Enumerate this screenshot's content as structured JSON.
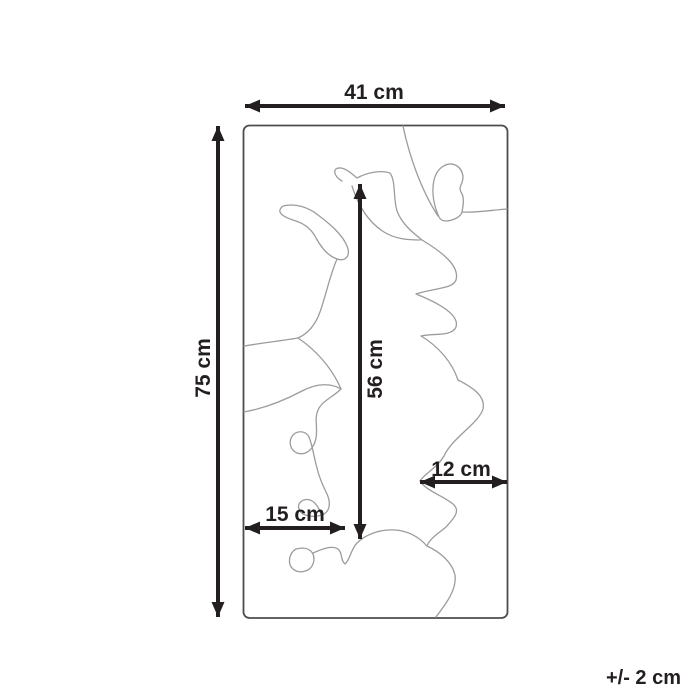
{
  "diagram": {
    "type": "product-dimension-diagram",
    "tolerance_label": "+/- 2 cm",
    "labels": {
      "width": "41 cm",
      "height": "75 cm",
      "inner_height": "56 cm",
      "inner_left_width": "15 cm",
      "inner_right_width": "12 cm"
    },
    "values_cm": {
      "width": 41,
      "height": 75,
      "inner_height": 56,
      "inner_left_width": 15,
      "inner_right_width": 12,
      "tolerance": 2
    },
    "colors": {
      "dimension_line": "#231f20",
      "product_outline": "#4d4d4f",
      "pattern_line": "#9c9c9c",
      "background": "#ffffff"
    }
  }
}
